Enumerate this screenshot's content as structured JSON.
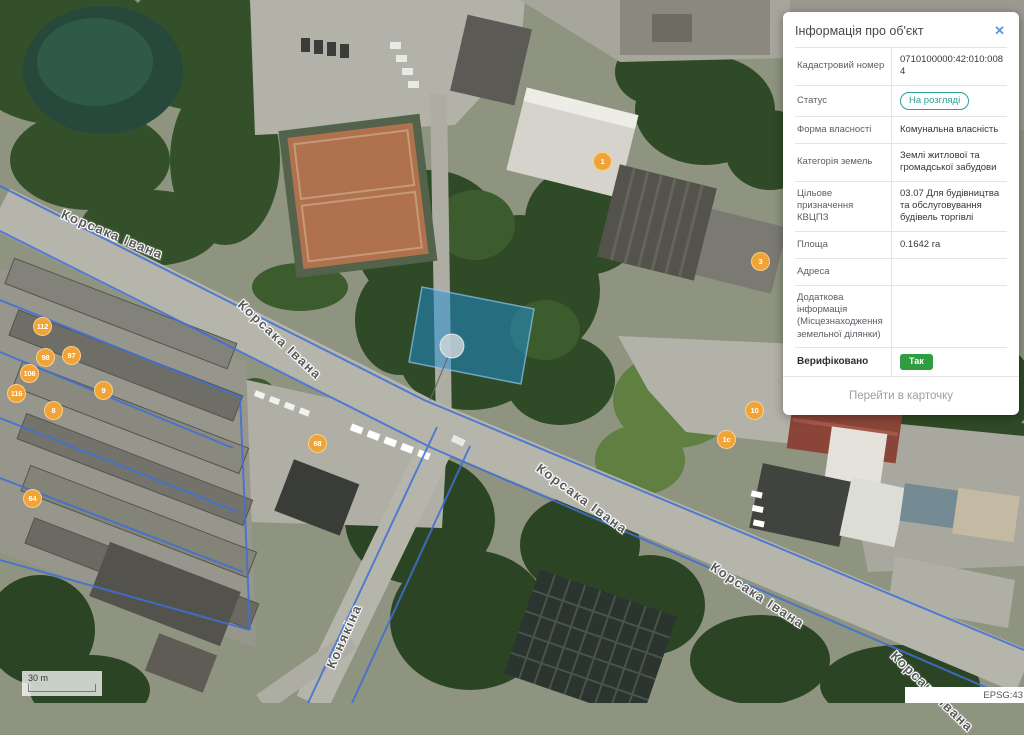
{
  "panel": {
    "title": "Інформація про об'єкт",
    "close_icon": "✕",
    "rows": [
      {
        "label": "Кадастровий номер",
        "value": "0710100000:42:010:0084"
      },
      {
        "label": "Статус",
        "value": "На розгляді"
      },
      {
        "label": "Форма власності",
        "value": "Комунальна власність"
      },
      {
        "label": "Категорія земель",
        "value": "Землі житлової та громадської забудови"
      },
      {
        "label": "Цільове призначення КВЦПЗ",
        "value": "03.07 Для будівництва та обслуговування будівель торгівлі"
      },
      {
        "label": "Площа",
        "value": "0.1642 га"
      },
      {
        "label": "Адреса",
        "value": ""
      },
      {
        "label": "Додаткова інформація (Місцезнаходження земельної ділянки)",
        "value": ""
      },
      {
        "label": "Верифіковано",
        "value": "Так"
      }
    ],
    "footer_link": "Перейти в карточку",
    "colors": {
      "status_badge": "#2b9e99",
      "verified_badge": "#2f9e41",
      "close_icon": "#5b9bd5"
    }
  },
  "map": {
    "street_labels": [
      {
        "text": "Корсака Івана"
      },
      {
        "text": "Корсака Івана"
      },
      {
        "text": "Корсака Івана"
      },
      {
        "text": "Корсака Івана"
      },
      {
        "text": "Корсака Івана"
      },
      {
        "text": "Конякіна"
      }
    ],
    "markers": [
      {
        "label": "1"
      },
      {
        "label": "3"
      },
      {
        "label": "112"
      },
      {
        "label": "97"
      },
      {
        "label": "98"
      },
      {
        "label": "106"
      },
      {
        "label": "116"
      },
      {
        "label": "9"
      },
      {
        "label": "8"
      },
      {
        "label": "68"
      },
      {
        "label": "10"
      },
      {
        "label": "1с"
      },
      {
        "label": "64"
      }
    ],
    "scale_label": "30 m",
    "epsg_label": "EPSG:43",
    "colors": {
      "cadastral_line": "#3f6fd6",
      "selected_parcel_fill": "#1e90d8",
      "marker_orange": "#f0a337"
    }
  }
}
